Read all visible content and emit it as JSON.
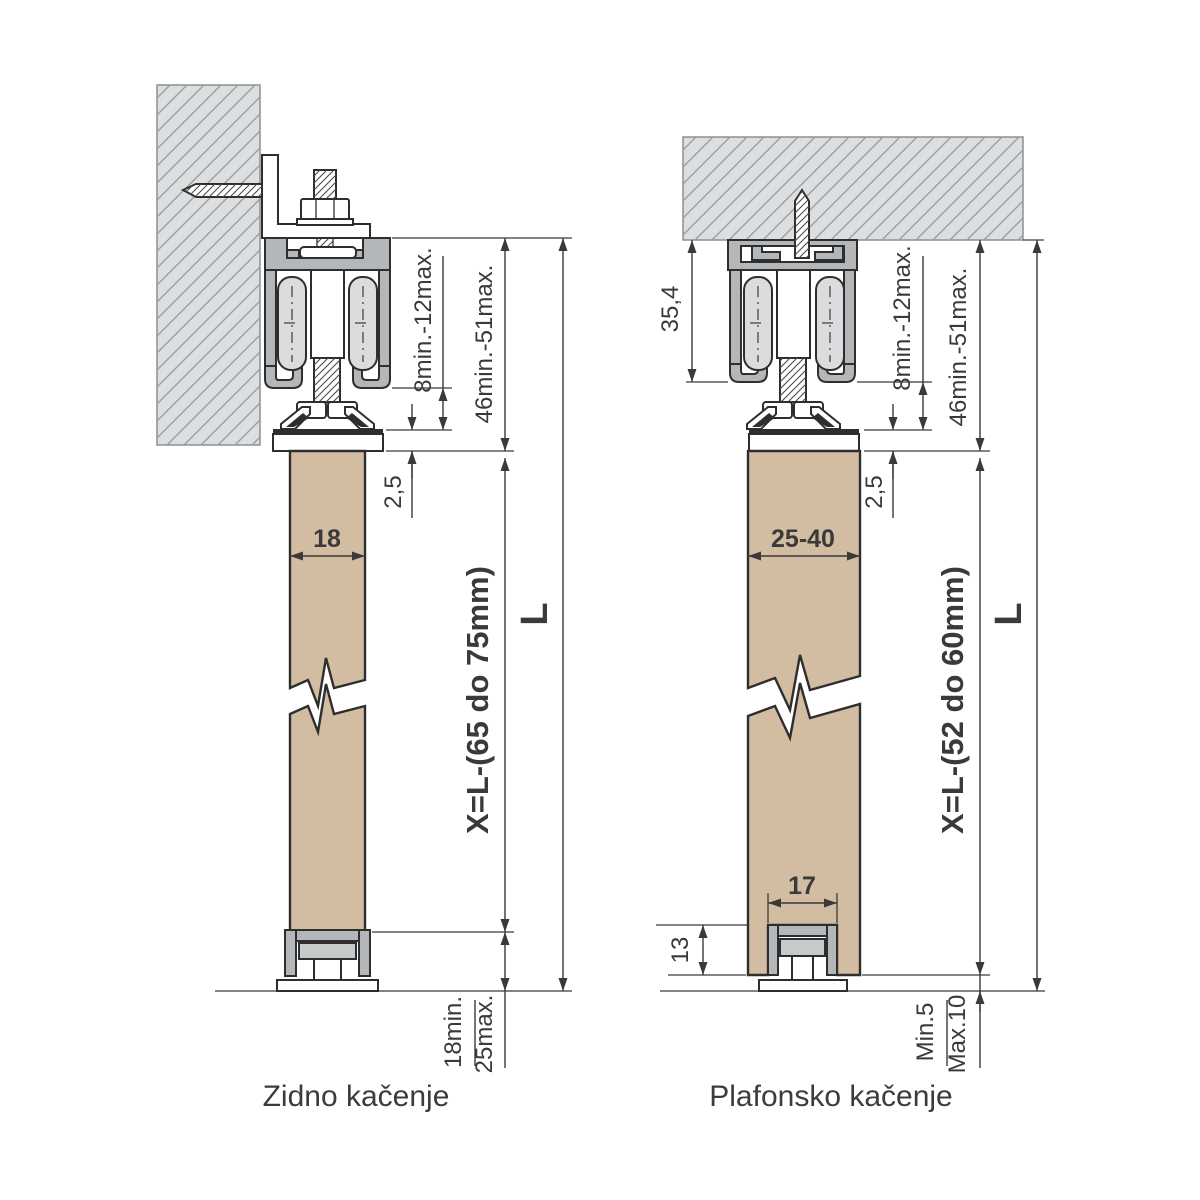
{
  "colors": {
    "door_panel": "#d3bda2",
    "metal_profile": "#b4b7b9",
    "roller": "#dadcdd",
    "hatch_fill": "#dcdedf",
    "hatch_line": "#98a0a4",
    "outline": "#2e2e2e",
    "dimension": "#3a3a3a"
  },
  "wall_mount": {
    "caption": "Zidno kačenje",
    "dim_hanger_adjust": "8min.-12max.",
    "dim_top_clearance": "46min.-51max.",
    "dim_plate_thickness": "2,5",
    "dim_door_width": "18",
    "dim_door_height": "X=L-(65 do 75mm)",
    "dim_total_height": "L",
    "dim_floor_gap_min": "18min.",
    "dim_floor_gap_max": "25max."
  },
  "ceiling_mount": {
    "caption": "Plafonsko kačenje",
    "dim_track_height": "35,4",
    "dim_hanger_adjust": "8min.-12max.",
    "dim_top_clearance": "46min.-51max.",
    "dim_plate_thickness": "2,5",
    "dim_door_width": "25-40",
    "dim_groove_width": "17",
    "dim_groove_depth": "13",
    "dim_door_height": "X=L-(52 do 60mm)",
    "dim_total_height": "L",
    "dim_floor_gap_min": "Min.5",
    "dim_floor_gap_max": "Max.10"
  }
}
